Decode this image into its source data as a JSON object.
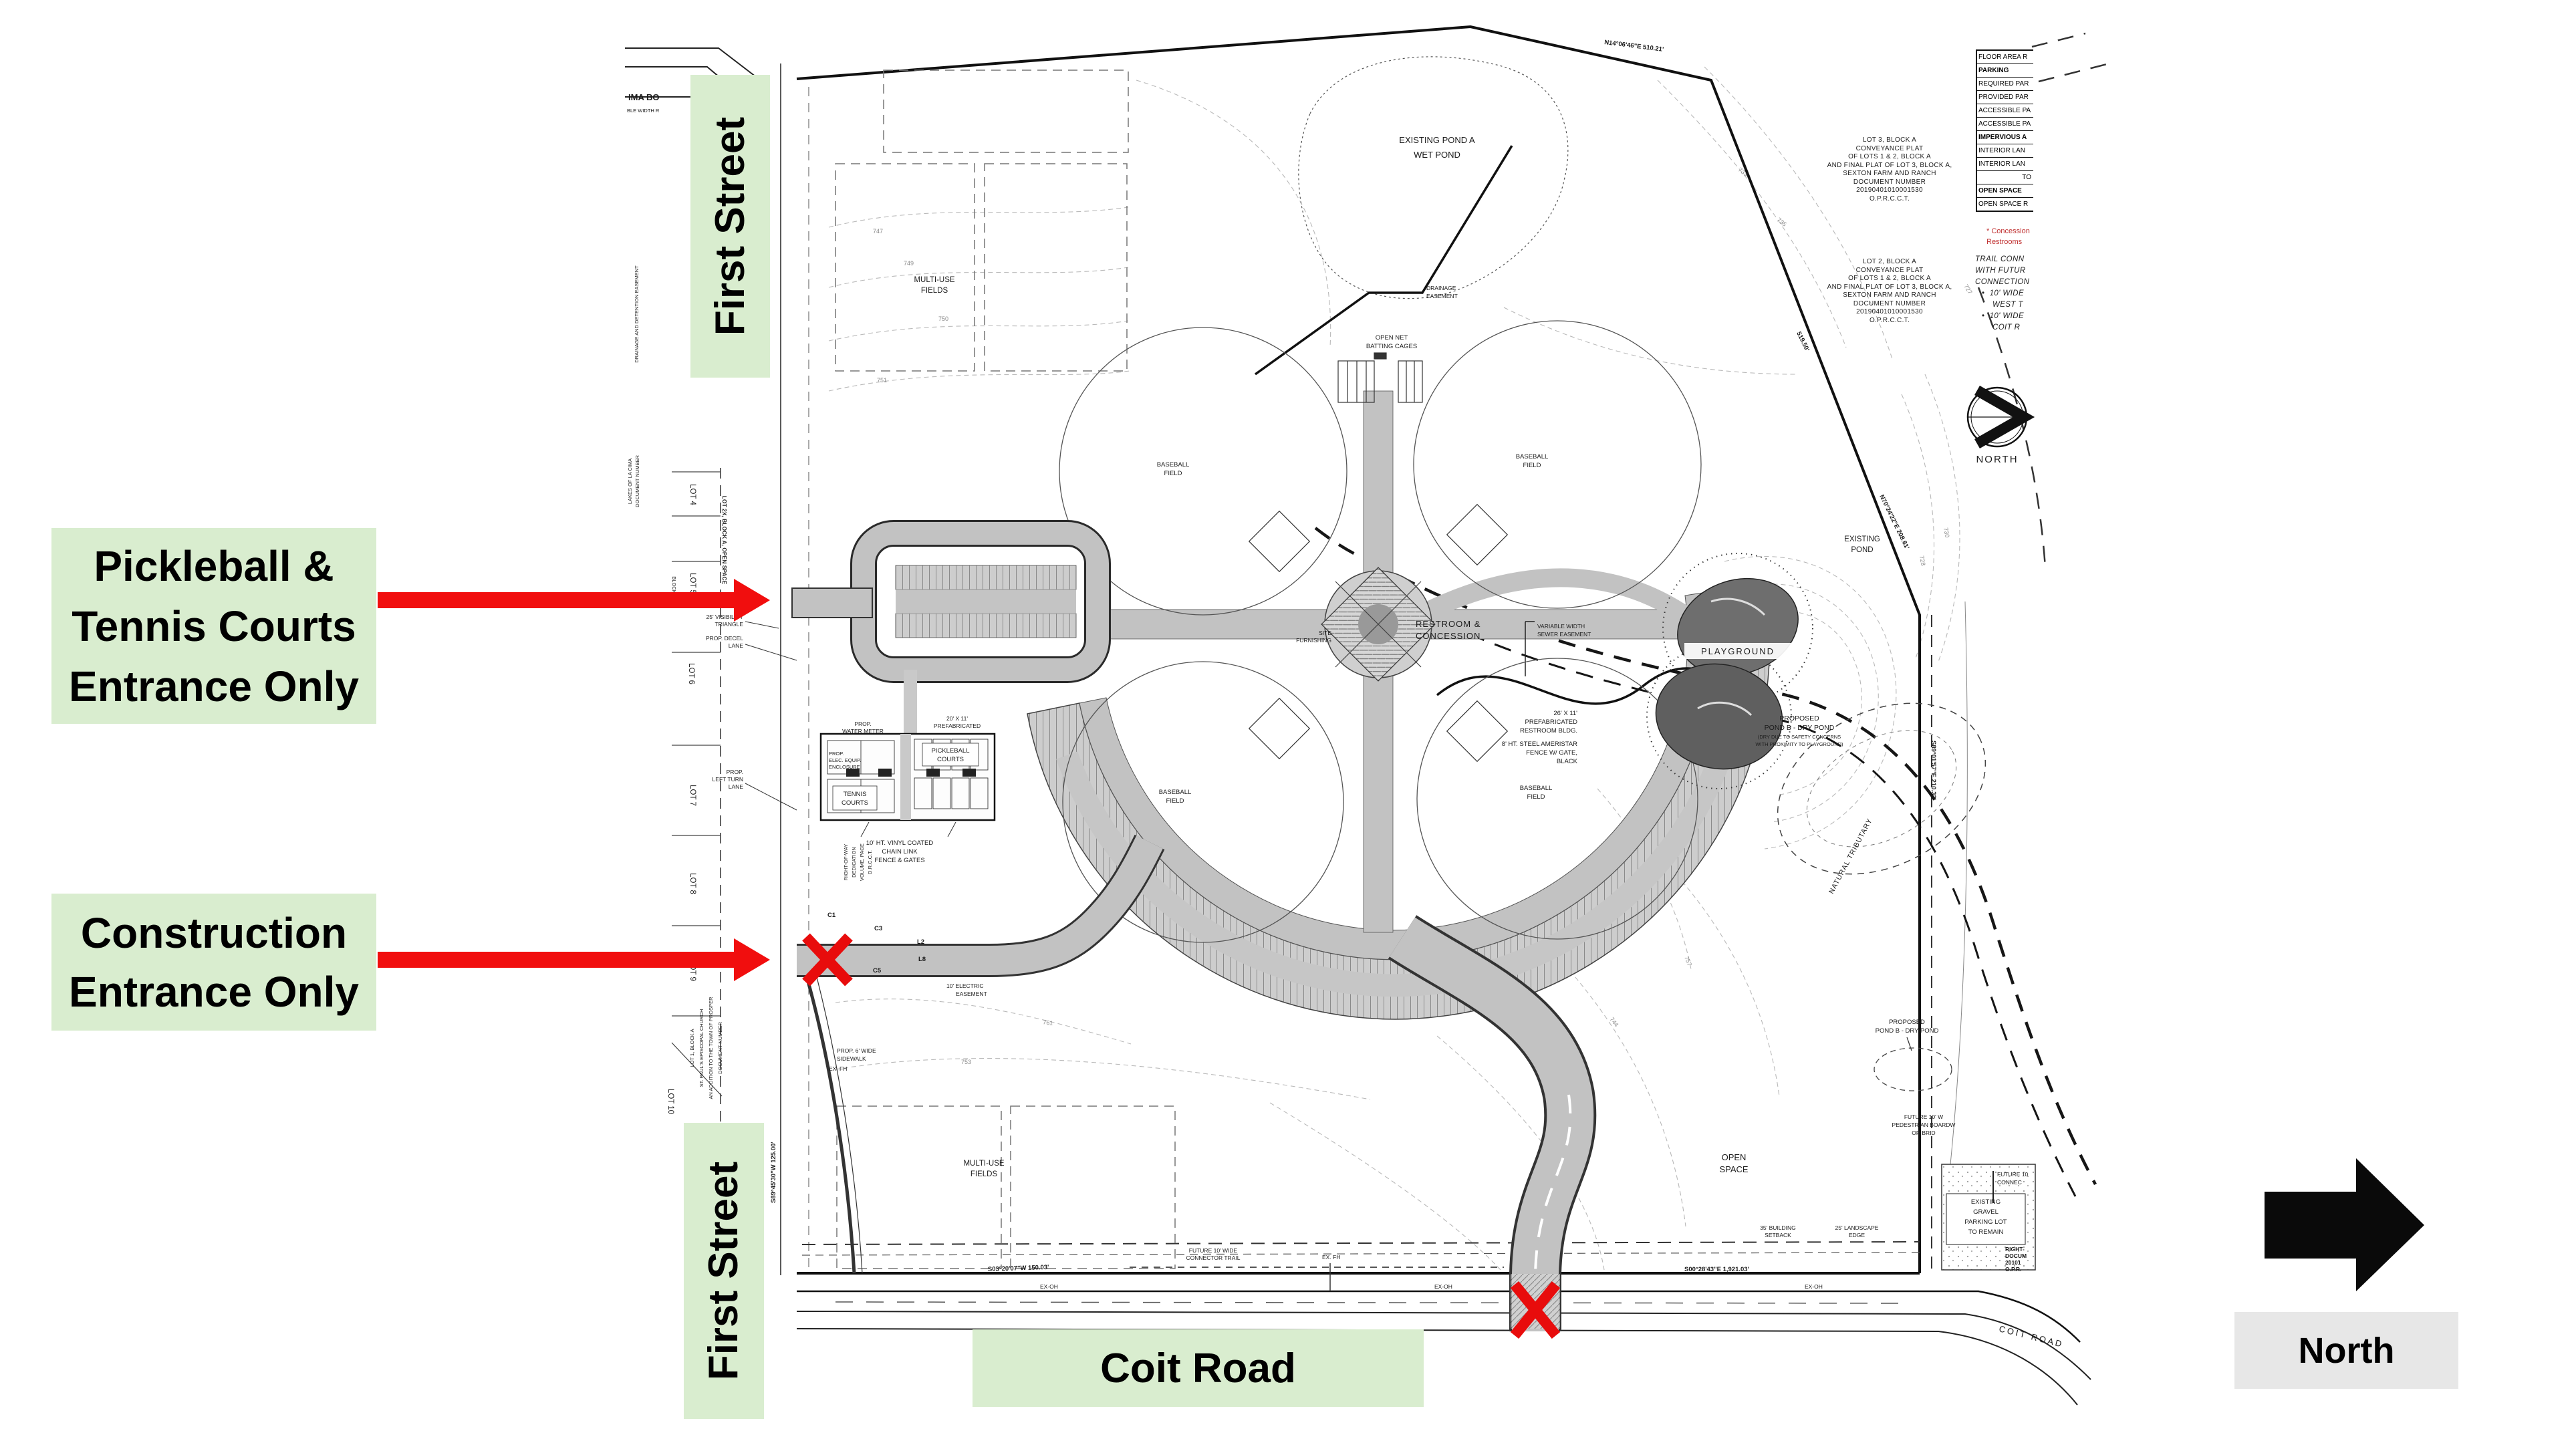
{
  "colors": {
    "label_green": "#d9edcf",
    "north_gray": "#e7e7e7",
    "annotation_red": "#f10e0e",
    "road_gray": "#c2c2c2",
    "line_black": "#111111"
  },
  "overlay": {
    "pickleball_lines": [
      "Pickleball &",
      "Tennis Courts",
      "Entrance Only"
    ],
    "construction_lines": [
      "Construction",
      "Entrance Only"
    ],
    "first_street_top": "First Street",
    "first_street_bottom": "First Street",
    "coit_road": "Coit Road",
    "north": "North"
  },
  "plan": {
    "summary_table": {
      "rows": [
        "FLOOR AREA R",
        "PARKING",
        "REQUIRED PAR",
        "PROVIDED PAR",
        "ACCESSIBLE PA",
        "ACCESSIBLE PA",
        "IMPERVIOUS A",
        "INTERIOR LAN",
        "INTERIOR LAN",
        "TO",
        "OPEN SPACE",
        "OPEN SPACE R"
      ]
    },
    "concession_note": [
      "* Concession",
      "Restrooms"
    ],
    "trail_note": {
      "lines": [
        "TRAIL  CONN",
        "WITH  FUTUR",
        "CONNECTION"
      ],
      "bullet1": [
        "10'  WIDE",
        "WEST  T"
      ],
      "bullet2": [
        "10'  WIDE",
        "COIT  R"
      ]
    },
    "lot3_plat": [
      "LOT 3, BLOCK A",
      "CONVEYANCE PLAT",
      "OF LOTS 1 & 2, BLOCK A",
      "AND FINAL PLAT OF LOT 3, BLOCK A,",
      "SEXTON FARM AND RANCH",
      "DOCUMENT NUMBER",
      "20190401010001530",
      "O.P.R.C.C.T."
    ],
    "lot2_plat": [
      "LOT 2, BLOCK A",
      "CONVEYANCE PLAT",
      "OF LOTS 1 & 2, BLOCK A",
      "AND FINAL PLAT OF LOT 3, BLOCK A,",
      "SEXTON FARM AND RANCH",
      "DOCUMENT NUMBER",
      "20190401010001530",
      "O.P.R.C.C.T."
    ],
    "labels": {
      "ima_bo": "IMA BO",
      "ble_width": "BLE WIDTH R",
      "existing_pond_a": [
        "EXISTING POND A",
        "WET POND"
      ],
      "drainage_easement": [
        "DRAINAGE",
        "EASEMENT"
      ],
      "open_net": [
        "OPEN NET",
        "BATTING CAGES"
      ],
      "multi_use": [
        "MULTI-USE",
        "FIELDS"
      ],
      "baseball": [
        "BASEBALL",
        "FIELD"
      ],
      "restroom_concession": [
        "RESTROOM &",
        "CONCESSION"
      ],
      "playground": "PLAYGROUND",
      "tennis": [
        "TENNIS",
        "COURTS"
      ],
      "pickleball": [
        "PICKLEBALL",
        "COURTS"
      ],
      "fence_note": [
        "10' HT. VINYL COATED",
        "CHAIN LINK",
        "FENCE & GATES"
      ],
      "prop_water_meter": [
        "PROP.",
        "WATER METER"
      ],
      "prop_elec": [
        "PROP.",
        "ELEC. EQUIP.",
        "ENCLOSURE"
      ],
      "restroom_bldg_20": [
        "20' X 11'",
        "PREFABRICATED",
        "RESTROOM BLDG."
      ],
      "restroom_bldg_26": [
        "26' X 11'",
        "PREFABRICATED",
        "RESTROOM BLDG."
      ],
      "ameristar": [
        "8' HT. STEEL AMERISTAR",
        "FENCE W/ GATE,",
        "BLACK"
      ],
      "sewer_easement": [
        "VARIABLE WIDTH",
        "SEWER EASEMENT"
      ],
      "site_furnishing": [
        "SITE",
        "FURNISHING"
      ],
      "existing_pond": [
        "EXISTING",
        "POND"
      ],
      "pond_b_main": [
        "PROPOSED",
        "POND B - DRY POND",
        "(DRY DUE TO SAFETY CONCERNS",
        "WITH PROXIMITY TO PLAYGROUND)"
      ],
      "pond_b_south": [
        "PROPOSED",
        "POND B - DRY POND"
      ],
      "natural_tributary": "NATURAL TRIBUTARY",
      "open_space": [
        "OPEN",
        "SPACE"
      ],
      "gravel_lot": [
        "EXISTING",
        "GRAVEL",
        "PARKING LOT",
        "TO REMAIN"
      ],
      "building_setback": [
        "35' BUILDING",
        "SETBACK"
      ],
      "landscape_edge": [
        "25' LANDSCAPE",
        "EDGE"
      ],
      "boardwalk": [
        "FUTURE 10' W",
        "PEDESTRIAN BOARDW",
        "OR BRID"
      ],
      "future_connector": [
        "FUTURE 10' WIDE",
        "CONNECTOR TRAIL"
      ],
      "future_connect2": [
        "FUTURE 10",
        "CONNEC"
      ],
      "row_doc": [
        "RIGHT-",
        "DOCUM",
        "20101",
        "O.P.R."
      ],
      "coit_road_plan": "COIT ROAD",
      "ex_oh": "EX-OH",
      "ex_fh": "EX. FH",
      "sidewalk": [
        "PROP. 6' WIDE",
        "SIDEWALK"
      ],
      "electric_easement": [
        "10' ELECTRIC",
        "EASEMENT"
      ],
      "visibility": [
        "25' VISIBILITY",
        "TRIANGLE"
      ],
      "decel": [
        "PROP. DECEL",
        "LANE"
      ],
      "left_turn": [
        "PROP.",
        "LEFT TURN",
        "LANE"
      ],
      "row_dedication": [
        "RIGHT-OF-WAY",
        "DEDICATION",
        "VOLUME, PAGE",
        "D.R.C.C.T."
      ],
      "st_pauls": [
        "LOT 1, BLOCK A",
        "ST. PAUL'S EPISCOPAL CHURCH",
        "AN ADDITION TO THE TOWN OF PROSPER",
        "DOCUMENT NUMBER"
      ],
      "lakes": [
        "LAKES OF LA CIMA",
        "DOCUMENT NUMBER"
      ],
      "drainage_detention": "DRAINAGE AND DETENTION EASEMENT",
      "lot2x": "LOT 2X, BLOCK A, OPEN SPACE",
      "block": "BLOCK",
      "north_symbol": "NORTH",
      "c1": "C1",
      "c3": "C3",
      "c5": "C5",
      "l2": "L2",
      "l8": "L8"
    },
    "lots": [
      "LOT 4",
      "LOT 5",
      "LOT 6",
      "LOT 7",
      "LOT 8",
      "LOT 9",
      "LOT 10"
    ],
    "bearings": {
      "n14": "N14°06'46\"E  510.21'",
      "d519": "519.50'",
      "n70": "N70°24'22\"E  208.61'",
      "s89e": "S89°01'57\"E  210.32'",
      "s00": "S00°28'43\"E  1,921.03'",
      "s03": "S03°20'07\"W  150.03'",
      "s89w": "S89°45'30\"W  125.00'"
    },
    "contour_labels": {
      "c733": "733",
      "c735": "735",
      "c730": "730",
      "c728": "728",
      "c727": "727",
      "c744": "744",
      "c747": "747",
      "c749": "749",
      "c750": "750",
      "c751": "751",
      "c753": "753",
      "c761": "761",
      "c757": "757"
    }
  }
}
